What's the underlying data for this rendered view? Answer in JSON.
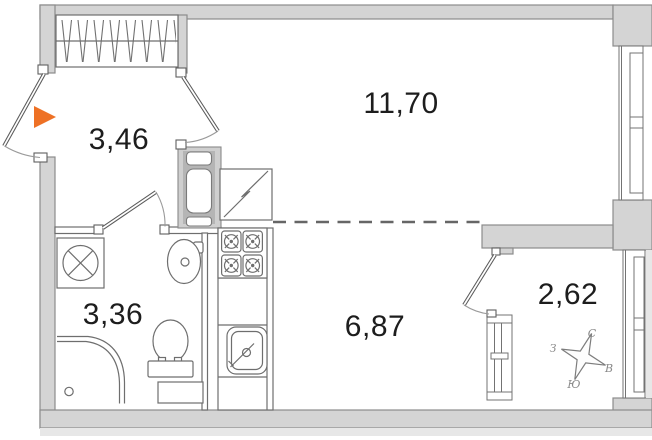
{
  "floor_plan": {
    "rooms": [
      {
        "name": "hallway",
        "area": "3,46"
      },
      {
        "name": "living-room",
        "area": "11,70"
      },
      {
        "name": "bathroom",
        "area": "3,36"
      },
      {
        "name": "kitchen-zone",
        "area": "6,87"
      },
      {
        "name": "balcony",
        "area": "2,62"
      }
    ],
    "compass": {
      "north": "С",
      "east": "В",
      "south": "Ю",
      "west": "З"
    },
    "colors": {
      "wall_fill": "#d4d4d4",
      "wall_outline": "#8c8c8c",
      "fixture_line": "#6e6e6e",
      "entrance_arrow": "#ee7125",
      "label_text": "#1d1d1d",
      "compass_text": "#8a8a8a",
      "exterior_strip": "#e7e7e7"
    },
    "fixtures": [
      "entrance-arrow-icon",
      "wardrobe",
      "ventilation-shaft",
      "fridge",
      "stove",
      "kitchen-sink",
      "washing-machine",
      "wash-basin",
      "toilet",
      "shower",
      "window",
      "door",
      "compass-rose-icon"
    ]
  }
}
